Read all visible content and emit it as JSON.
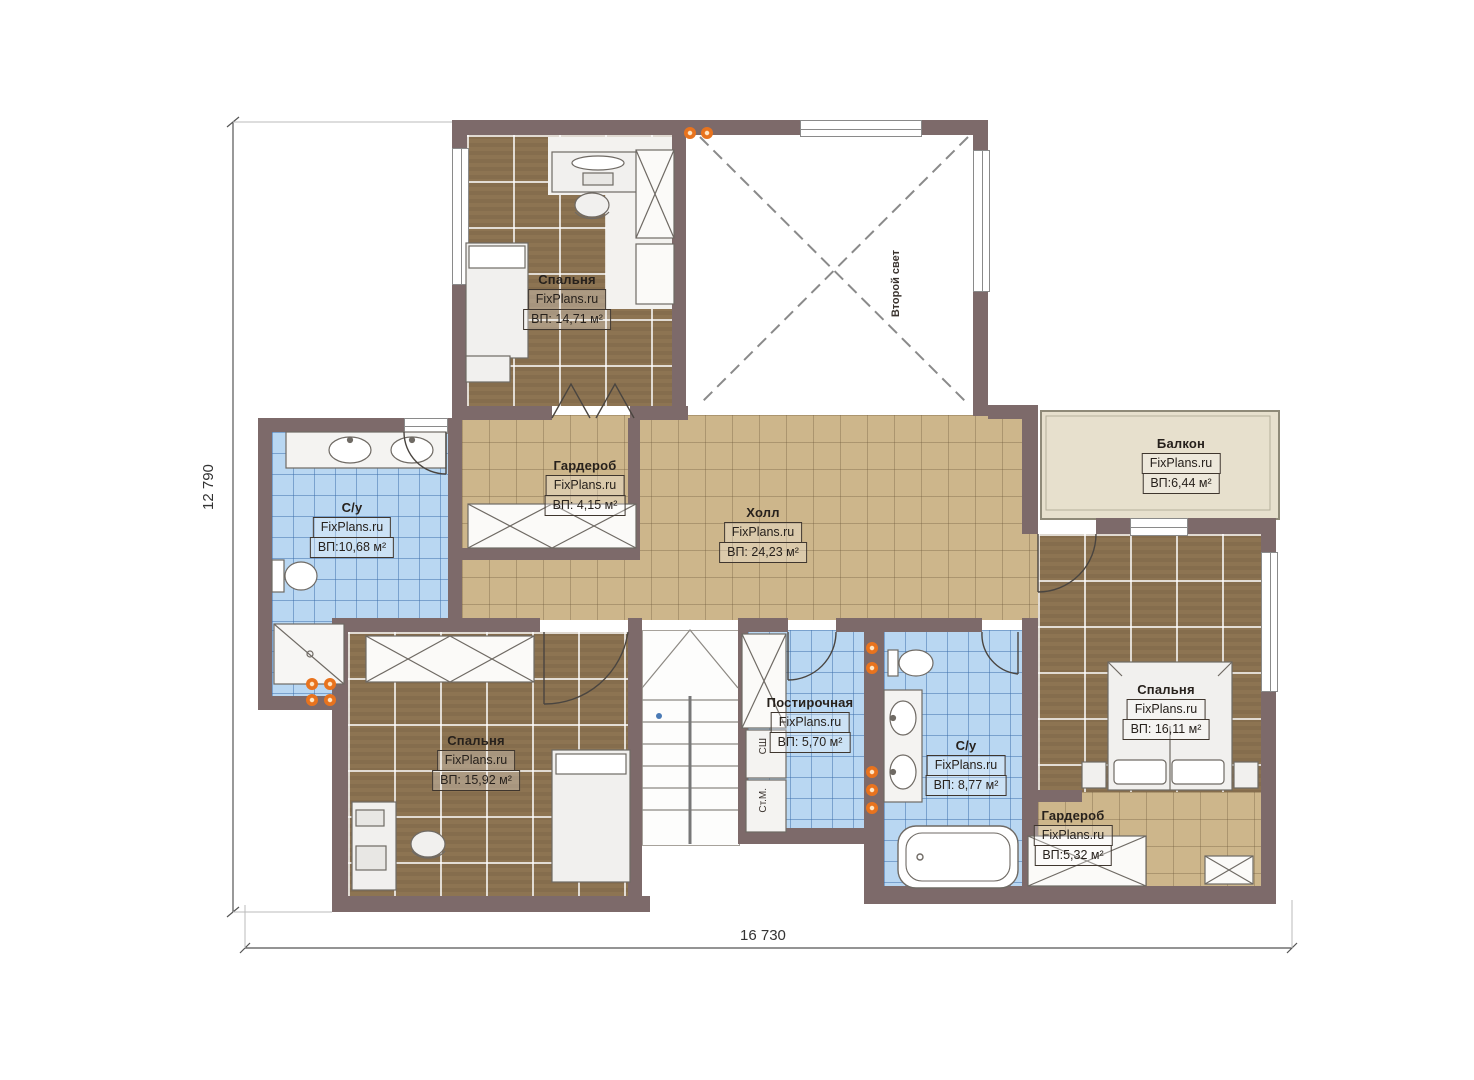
{
  "brand": "FixPlans.ru",
  "dimensions": {
    "height_label": "12 790",
    "width_label": "16 730"
  },
  "void_label": "Второй свет",
  "rooms": {
    "bedroom_top": {
      "name": "Спальня",
      "area": "ВП: 14,71 м²"
    },
    "wardrobe_top": {
      "name": "Гардероб",
      "area": "ВП: 4,15 м²"
    },
    "hall": {
      "name": "Холл",
      "area": "ВП: 24,23 м²"
    },
    "bath_left": {
      "name": "С/у",
      "area": "ВП:10,68 м²"
    },
    "balcony": {
      "name": "Балкон",
      "area": "ВП:6,44 м²"
    },
    "bedroom_left": {
      "name": "Спальня",
      "area": "ВП: 15,92 м²"
    },
    "laundry": {
      "name": "Постирочная",
      "area": "ВП: 5,70 м²"
    },
    "bath_right": {
      "name": "С/у",
      "area": "ВП: 8,77 м²"
    },
    "bedroom_right": {
      "name": "Спальня",
      "area": "ВП: 16,11 м²"
    },
    "wardrobe_bottom": {
      "name": "Гардероб",
      "area": "ВП:5,32 м²"
    }
  },
  "appliances": {
    "dryer": "СШ",
    "washer": "Ст.М."
  },
  "colors": {
    "wall": "#7d6a6a",
    "floor_wood": "#8d7452",
    "floor_tile": "#cdb68b",
    "floor_bath": "#b9d7f2",
    "floor_balcony": "#e7e0cd",
    "accent_dot": "#e8731e"
  }
}
